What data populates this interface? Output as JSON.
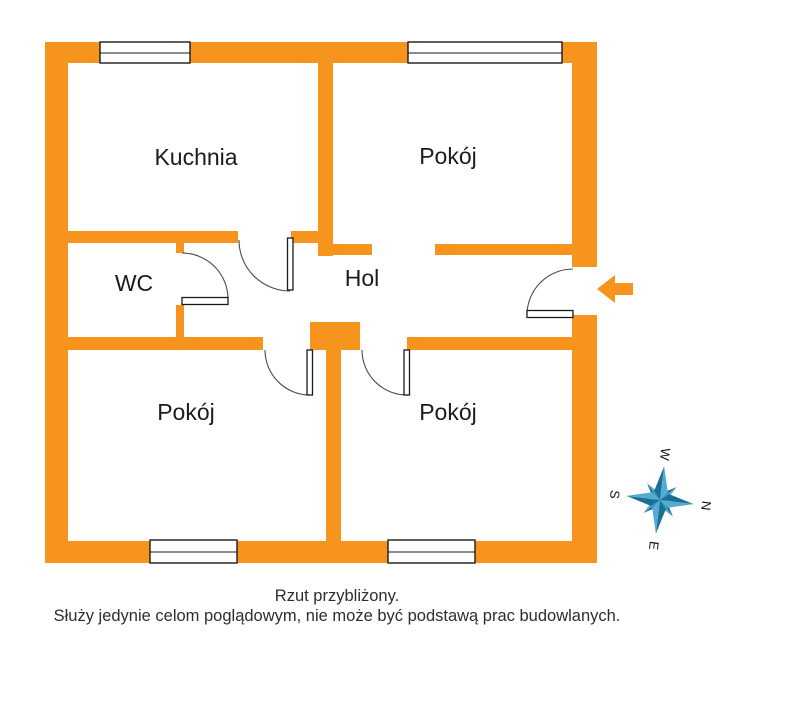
{
  "plan": {
    "title": "floor-plan",
    "rooms": {
      "kitchen": {
        "label": "Kuchnia"
      },
      "room_top_right": {
        "label": "Pokój"
      },
      "wc": {
        "label": "WC"
      },
      "hall": {
        "label": "Hol"
      },
      "room_bottom_left": {
        "label": "Pokój"
      },
      "room_bottom_right": {
        "label": "Pokój"
      }
    },
    "compass": {
      "n": "N",
      "e": "E",
      "s": "S",
      "w": "W"
    },
    "entrance": {
      "icon": "left-arrow",
      "meaning": "entrance"
    },
    "disclaimer": {
      "line1": "Rzut przybliżony.",
      "line2": "Służy jedynie celom poglądowym, nie może być podstawą prac budowlanych."
    },
    "colors": {
      "wall": "#F7941E",
      "compass_dark": "#1A6F94",
      "compass_light": "#54ACD2",
      "label_text": "#1b1b1b",
      "disclaimer_text": "#2d2d2d"
    }
  }
}
